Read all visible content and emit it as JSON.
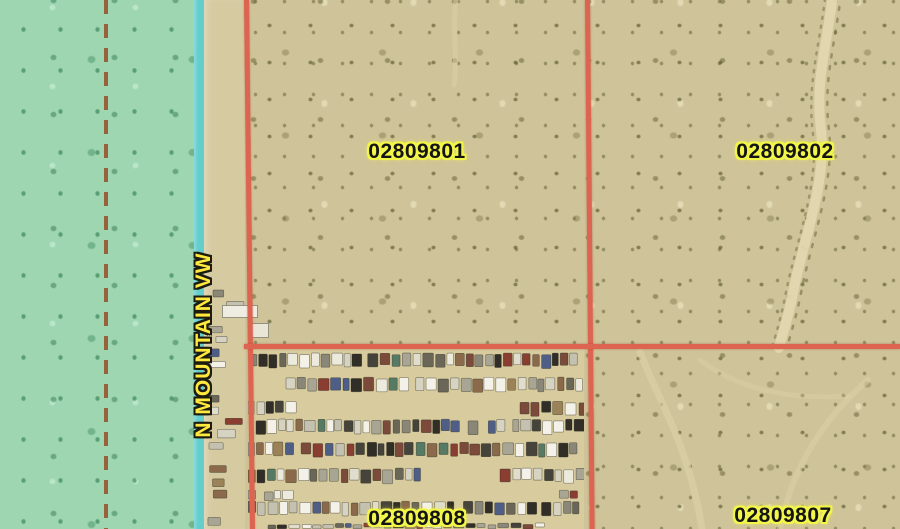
{
  "map": {
    "parcels": {
      "p801": {
        "id": "02809801"
      },
      "p802": {
        "id": "02809802"
      },
      "p808": {
        "id": "02809808"
      },
      "p807": {
        "id": "02809807"
      }
    },
    "road": {
      "name": "N MOUNTAIN VW"
    }
  },
  "colors": {
    "desert_base": "#cfc399",
    "overlay_teal": "#9fd6b2",
    "road_edge_cyan": "#63cecc",
    "dashed_boundary": "#96613c",
    "parcel_line": "#dd6450",
    "label_text": "#141414",
    "label_halo": "#f2f649",
    "road_label_text": "#ffe93e",
    "road_label_outline": "#1c1c10",
    "junkyard_ground": "#d8cc9f"
  },
  "junkyard_palette": [
    "#f4f2e8",
    "#f4f2e8",
    "#eceadc",
    "#e0ddcc",
    "#d6d3c2",
    "#c4c1b0",
    "#a8a594",
    "#8a8778",
    "#6a6758",
    "#46443a",
    "#302e26",
    "#302e26",
    "#8a6a4a",
    "#9c8258",
    "#8a3e32",
    "#7c4a3a",
    "#4e5e86",
    "#567a64"
  ]
}
